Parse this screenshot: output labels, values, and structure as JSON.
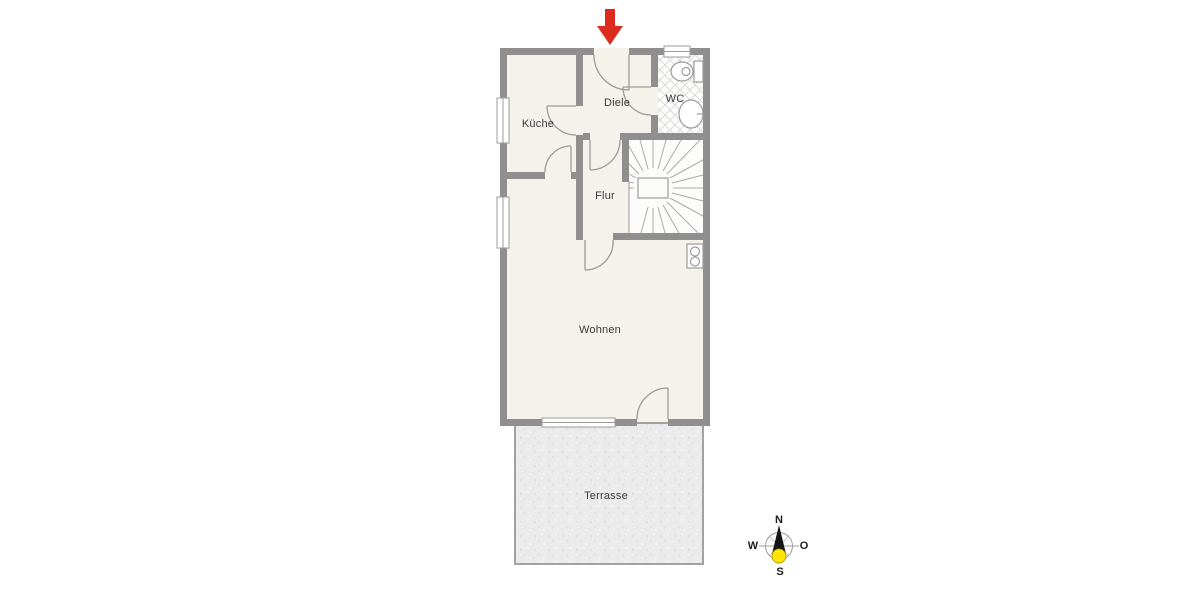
{
  "rooms": {
    "kueche": {
      "label": "Küche"
    },
    "diele": {
      "label": "Diele"
    },
    "wc": {
      "label": "WC"
    },
    "flur": {
      "label": "Flur"
    },
    "wohnen": {
      "label": "Wohnen"
    },
    "terrasse": {
      "label": "Terrasse"
    }
  },
  "compass": {
    "north": "N",
    "east": "O",
    "south": "S",
    "west": "W"
  },
  "colors": {
    "wall": "#908e8f",
    "floor": "#f5f2ec",
    "stair_floor": "#fcfcfb",
    "terrace_fill": "#ebebeb",
    "terrace_border": "#a2a2a2",
    "thin_line": "#9b9b9b",
    "tile_line": "#dcdcdc",
    "entrance_arrow": "#dd2c1f",
    "compass_needle": "#151515",
    "compass_south": "#ffe500",
    "label_text": "#3b3b3b"
  },
  "icons": {
    "entrance_arrow": "entrance-arrow-icon (red down arrow marking entry door)",
    "toilet": "toilet-icon",
    "sink": "sink-icon",
    "stairs": "winder-stairs-icon",
    "heater": "heater-fixture-icon",
    "compass": "compass-rose-icon"
  }
}
